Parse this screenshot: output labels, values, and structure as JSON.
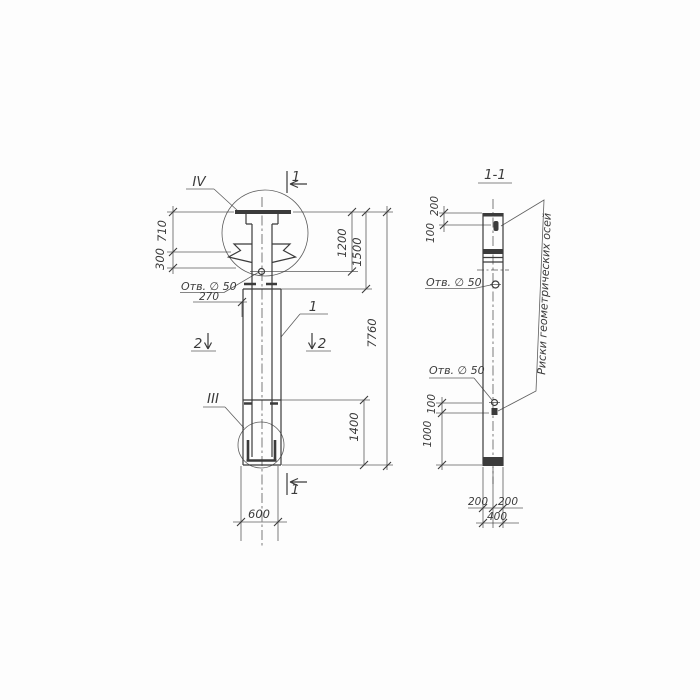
{
  "front": {
    "detail_top": "IV",
    "detail_bottom": "III",
    "cut_top": "1",
    "cut_bottom": "1",
    "cut_left": "2",
    "cut_right": "2",
    "pos": "1",
    "hole": "Отв. ∅ 50",
    "d710": "710",
    "d300": "300",
    "d270": "270",
    "d1200": "1200",
    "d1500": "1500",
    "d1400": "1400",
    "d7760": "7760",
    "d600": "600"
  },
  "section": {
    "title": "1-1",
    "hole_top": "Отв. ∅ 50",
    "hole_bottom": "Отв. ∅ 50",
    "axes_note": "Риски геометрических осей",
    "d200": "200",
    "d100": "100",
    "d100b": "100",
    "d1000": "1000",
    "d200l": "200",
    "d200r": "200",
    "d400": "400"
  },
  "colors": {
    "ink": "#3b3b3b",
    "paper": "#fdfdfd"
  }
}
